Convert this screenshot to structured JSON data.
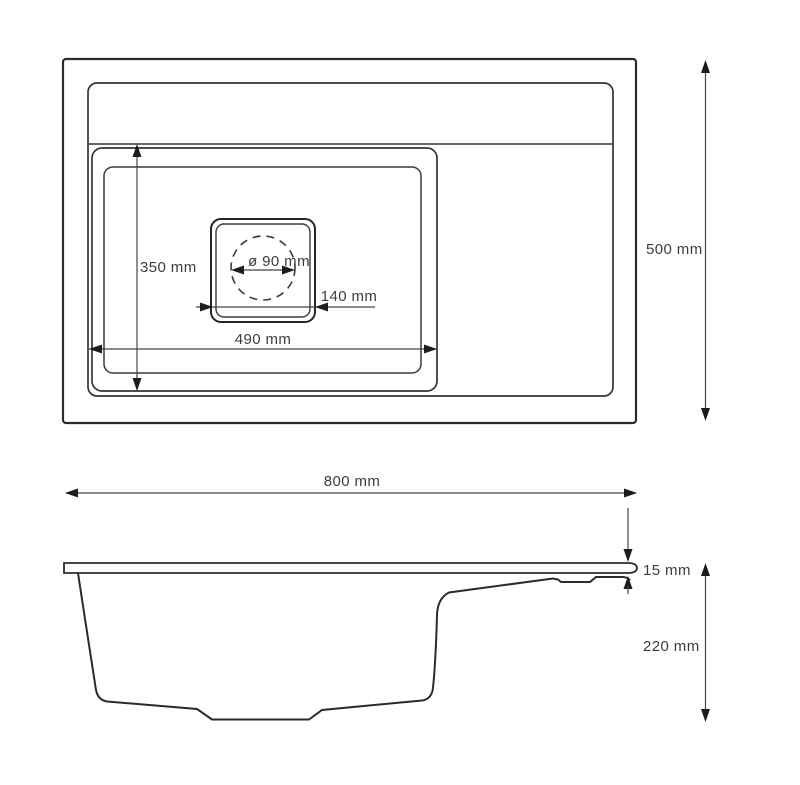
{
  "drawing": {
    "type": "sink-technical-drawing",
    "background_color": "#ffffff",
    "outline_color": "#2e2e2e",
    "dimension_line_color": "#454545",
    "text_color": "#3d3d3d",
    "views": {
      "top_view": {
        "name": "Top view"
      },
      "side_view": {
        "name": "Side view"
      }
    }
  },
  "dimensions": {
    "bowl_depth": {
      "label": "350 mm"
    },
    "drain_diameter": {
      "label": "ø 90 mm"
    },
    "drain_width": {
      "label": "140 mm"
    },
    "bowl_length": {
      "label": "490 mm"
    },
    "overall_depth": {
      "label": "500 mm"
    },
    "overall_width": {
      "label": "800 mm"
    },
    "rim_thickness": {
      "label": "15 mm"
    },
    "bowl_height": {
      "label": "220 mm"
    }
  }
}
